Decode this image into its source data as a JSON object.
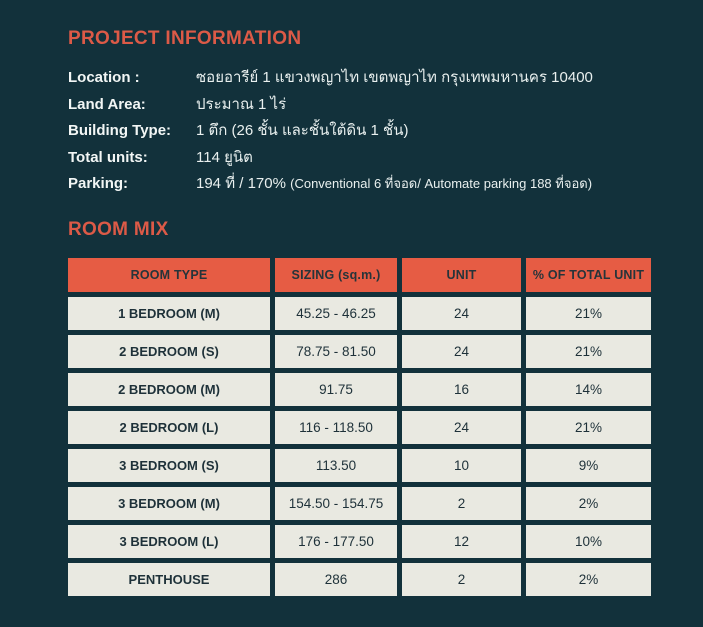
{
  "colors": {
    "background": "#12313B",
    "accent_heading": "#DC5A47",
    "table_header_bg": "#E65C44",
    "table_cell_bg": "#E9E9E1",
    "table_text": "#1E3139",
    "body_text": "#F2F6F5"
  },
  "project_info": {
    "title": "PROJECT INFORMATION",
    "fields": [
      {
        "label": "Location :",
        "value": "ซอยอารีย์ 1 แขวงพญาไท เขตพญาไท กรุงเทพมหานคร 10400"
      },
      {
        "label": "Land Area:",
        "value": "ประมาณ 1 ไร่"
      },
      {
        "label": "Building Type:",
        "value": "1 ตึก (26 ชั้น และชั้นใต้ดิน 1 ชั้น)"
      },
      {
        "label": "Total units:",
        "value": "114 ยูนิต"
      },
      {
        "label": "Parking:",
        "value": "194 ที่ / 170%",
        "note": "(Conventional 6 ที่จอด/ Automate parking 188 ที่จอด)"
      }
    ]
  },
  "room_mix": {
    "title": "ROOM MIX",
    "table": {
      "headers": [
        "ROOM TYPE",
        "SIZING (sq.m.)",
        "UNIT",
        "% OF TOTAL UNIT"
      ],
      "rows": [
        [
          "1 BEDROOM (M)",
          "45.25 - 46.25",
          "24",
          "21%"
        ],
        [
          "2 BEDROOM (S)",
          "78.75 - 81.50",
          "24",
          "21%"
        ],
        [
          "2 BEDROOM (M)",
          "91.75",
          "16",
          "14%"
        ],
        [
          "2 BEDROOM (L)",
          "116 - 118.50",
          "24",
          "21%"
        ],
        [
          "3 BEDROOM (S)",
          "113.50",
          "10",
          "9%"
        ],
        [
          "3 BEDROOM (M)",
          "154.50 - 154.75",
          "2",
          "2%"
        ],
        [
          "3 BEDROOM (L)",
          "176 - 177.50",
          "12",
          "10%"
        ],
        [
          "PENTHOUSE",
          "286",
          "2",
          "2%"
        ]
      ]
    }
  }
}
